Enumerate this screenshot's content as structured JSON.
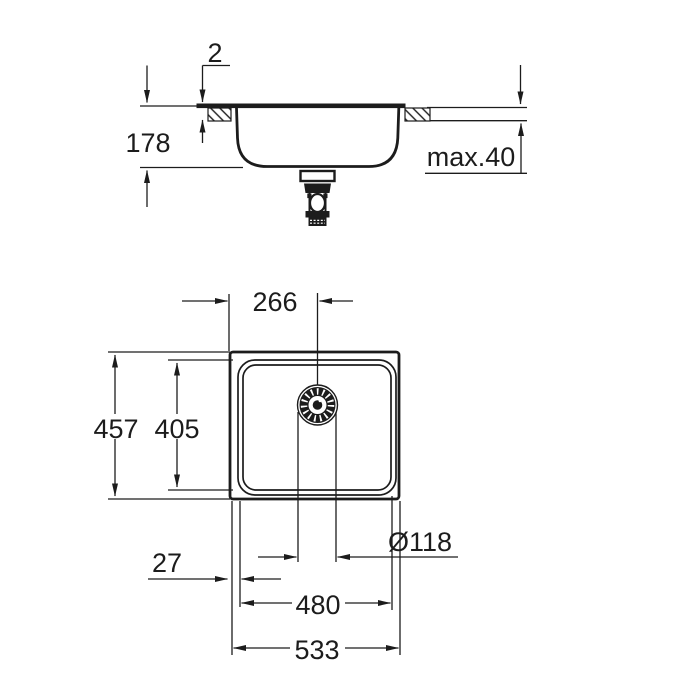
{
  "drawing": {
    "subject": "kitchen sink installation dimension drawing",
    "background": "#ffffff",
    "line_color": "#1c1c1c",
    "side_view": {
      "labels": {
        "rim_height": "2",
        "depth": "178",
        "counter_thickness": "max.40"
      }
    },
    "plan_view": {
      "labels": {
        "drain_offset": "266",
        "overall_depth": "457",
        "bowl_inner_depth": "405",
        "drain_diameter": "Ø118",
        "edge_offset": "27",
        "bowl_inner_width": "480",
        "overall_width": "533"
      }
    }
  }
}
